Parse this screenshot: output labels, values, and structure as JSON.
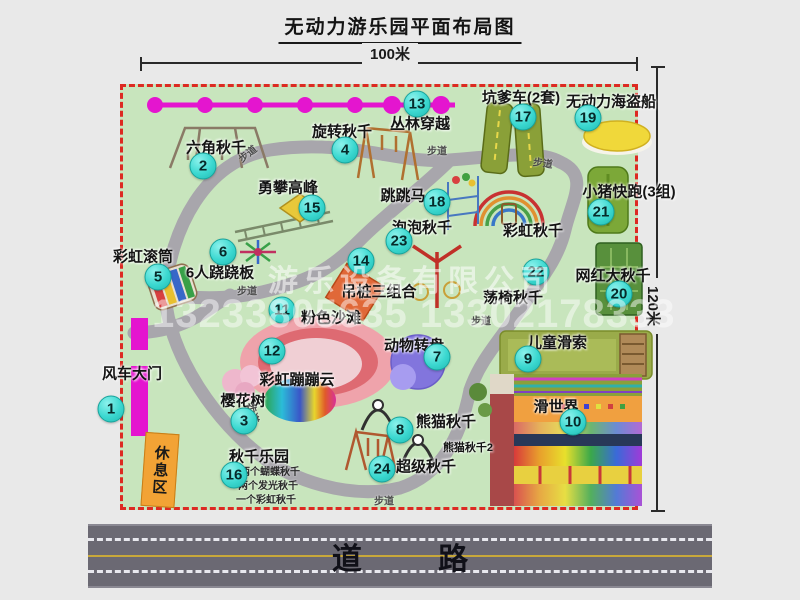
{
  "title": "无动力游乐园平面布局图",
  "dimensions": {
    "width_label": "100米",
    "height_label": "120米"
  },
  "road": {
    "label": "道 路"
  },
  "watermark": {
    "company": "游乐设备有限公司",
    "phone": "13233805635 13302178333"
  },
  "rest_area_label": "休息区",
  "attractions": [
    {
      "num": "1",
      "label": "风车大门",
      "bx": 111,
      "by": 409,
      "lx": 132,
      "ly": 373
    },
    {
      "num": "2",
      "label": "六角秋千",
      "bx": 203,
      "by": 166,
      "lx": 216,
      "ly": 147
    },
    {
      "num": "3",
      "label": "樱花树",
      "bx": 244,
      "by": 421,
      "lx": 243,
      "ly": 400
    },
    {
      "num": "4",
      "label": "旋转秋千",
      "bx": 345,
      "by": 150,
      "lx": 342,
      "ly": 131
    },
    {
      "num": "5",
      "label": "彩虹滚筒",
      "bx": 158,
      "by": 277,
      "lx": 143,
      "ly": 256
    },
    {
      "num": "6",
      "label": "6人跷跷板",
      "bx": 223,
      "by": 252,
      "lx": 220,
      "ly": 272
    },
    {
      "num": "7",
      "label": "动物转盘",
      "bx": 437,
      "by": 357,
      "lx": 414,
      "ly": 345
    },
    {
      "num": "8",
      "label": "熊猫秋千",
      "bx": 400,
      "by": 430,
      "lx": 446,
      "ly": 421
    },
    {
      "num": "9",
      "label": "儿童滑索",
      "bx": 528,
      "by": 359,
      "lx": 557,
      "ly": 342
    },
    {
      "num": "10",
      "label": "滑世界",
      "bx": 573,
      "by": 422,
      "lx": 556,
      "ly": 406
    },
    {
      "num": "11",
      "label": "粉色沙滩",
      "bx": 282,
      "by": 310,
      "lx": 331,
      "ly": 317
    },
    {
      "num": "12",
      "label": "彩虹蹦蹦云",
      "bx": 272,
      "by": 351,
      "lx": 297,
      "ly": 379
    },
    {
      "num": "13",
      "label": "丛林穿越",
      "bx": 417,
      "by": 104,
      "lx": 420,
      "ly": 123
    },
    {
      "num": "14",
      "label": "吊桩三组合",
      "bx": 361,
      "by": 261,
      "lx": 379,
      "ly": 291
    },
    {
      "num": "15",
      "label": "勇攀高峰",
      "bx": 312,
      "by": 208,
      "lx": 288,
      "ly": 187
    },
    {
      "num": "16",
      "label": "秋千乐园",
      "bx": 234,
      "by": 475,
      "lx": 259,
      "ly": 456
    },
    {
      "num": "17",
      "label": "坑爹车(2套)",
      "bx": 523,
      "by": 117,
      "lx": 521,
      "ly": 97
    },
    {
      "num": "18",
      "label": "跳跳马",
      "bx": 437,
      "by": 202,
      "lx": 403,
      "ly": 195
    },
    {
      "num": "19",
      "label": "无动力海盗船",
      "bx": 588,
      "by": 118,
      "lx": 611,
      "ly": 101
    },
    {
      "num": "20",
      "label": "网红大秋千",
      "bx": 619,
      "by": 294,
      "lx": 613,
      "ly": 275
    },
    {
      "num": "21",
      "label": "小猪快跑(3组)",
      "bx": 601,
      "by": 212,
      "lx": 629,
      "ly": 191
    },
    {
      "num": "22",
      "label": "荡椅秋千",
      "bx": 536,
      "by": 272,
      "lx": 513,
      "ly": 297
    },
    {
      "num": "23",
      "label": "泡泡秋千",
      "bx": 399,
      "by": 241,
      "lx": 422,
      "ly": 227
    },
    {
      "num": "24",
      "label": "超级秋千",
      "bx": 382,
      "by": 469,
      "lx": 426,
      "ly": 466
    }
  ],
  "extra_labels": [
    {
      "id": "rainbow-swing-label",
      "text": "彩虹秋千",
      "x": 533,
      "y": 230,
      "size": 15
    },
    {
      "id": "panda-swing-2-label",
      "text": "熊猫秋千2",
      "x": 468,
      "y": 447,
      "size": 11
    }
  ],
  "swing_park_notes": [
    {
      "text": "两个蝴蝶秋千",
      "x": 240,
      "y": 463
    },
    {
      "text": "两个发光秋千",
      "x": 238,
      "y": 477
    },
    {
      "text": "一个彩虹秋千",
      "x": 236,
      "y": 491
    }
  ],
  "path_labels": [
    {
      "text": "步道",
      "x": 247,
      "y": 153,
      "rot": -38
    },
    {
      "text": "步道",
      "x": 437,
      "y": 150,
      "rot": 0
    },
    {
      "text": "步道",
      "x": 543,
      "y": 162,
      "rot": 8
    },
    {
      "text": "步道",
      "x": 247,
      "y": 290,
      "rot": 0
    },
    {
      "text": "步道",
      "x": 481,
      "y": 320,
      "rot": 0
    },
    {
      "text": "步道",
      "x": 254,
      "y": 413,
      "rot": 75
    },
    {
      "text": "步道",
      "x": 384,
      "y": 500,
      "rot": 0
    }
  ]
}
